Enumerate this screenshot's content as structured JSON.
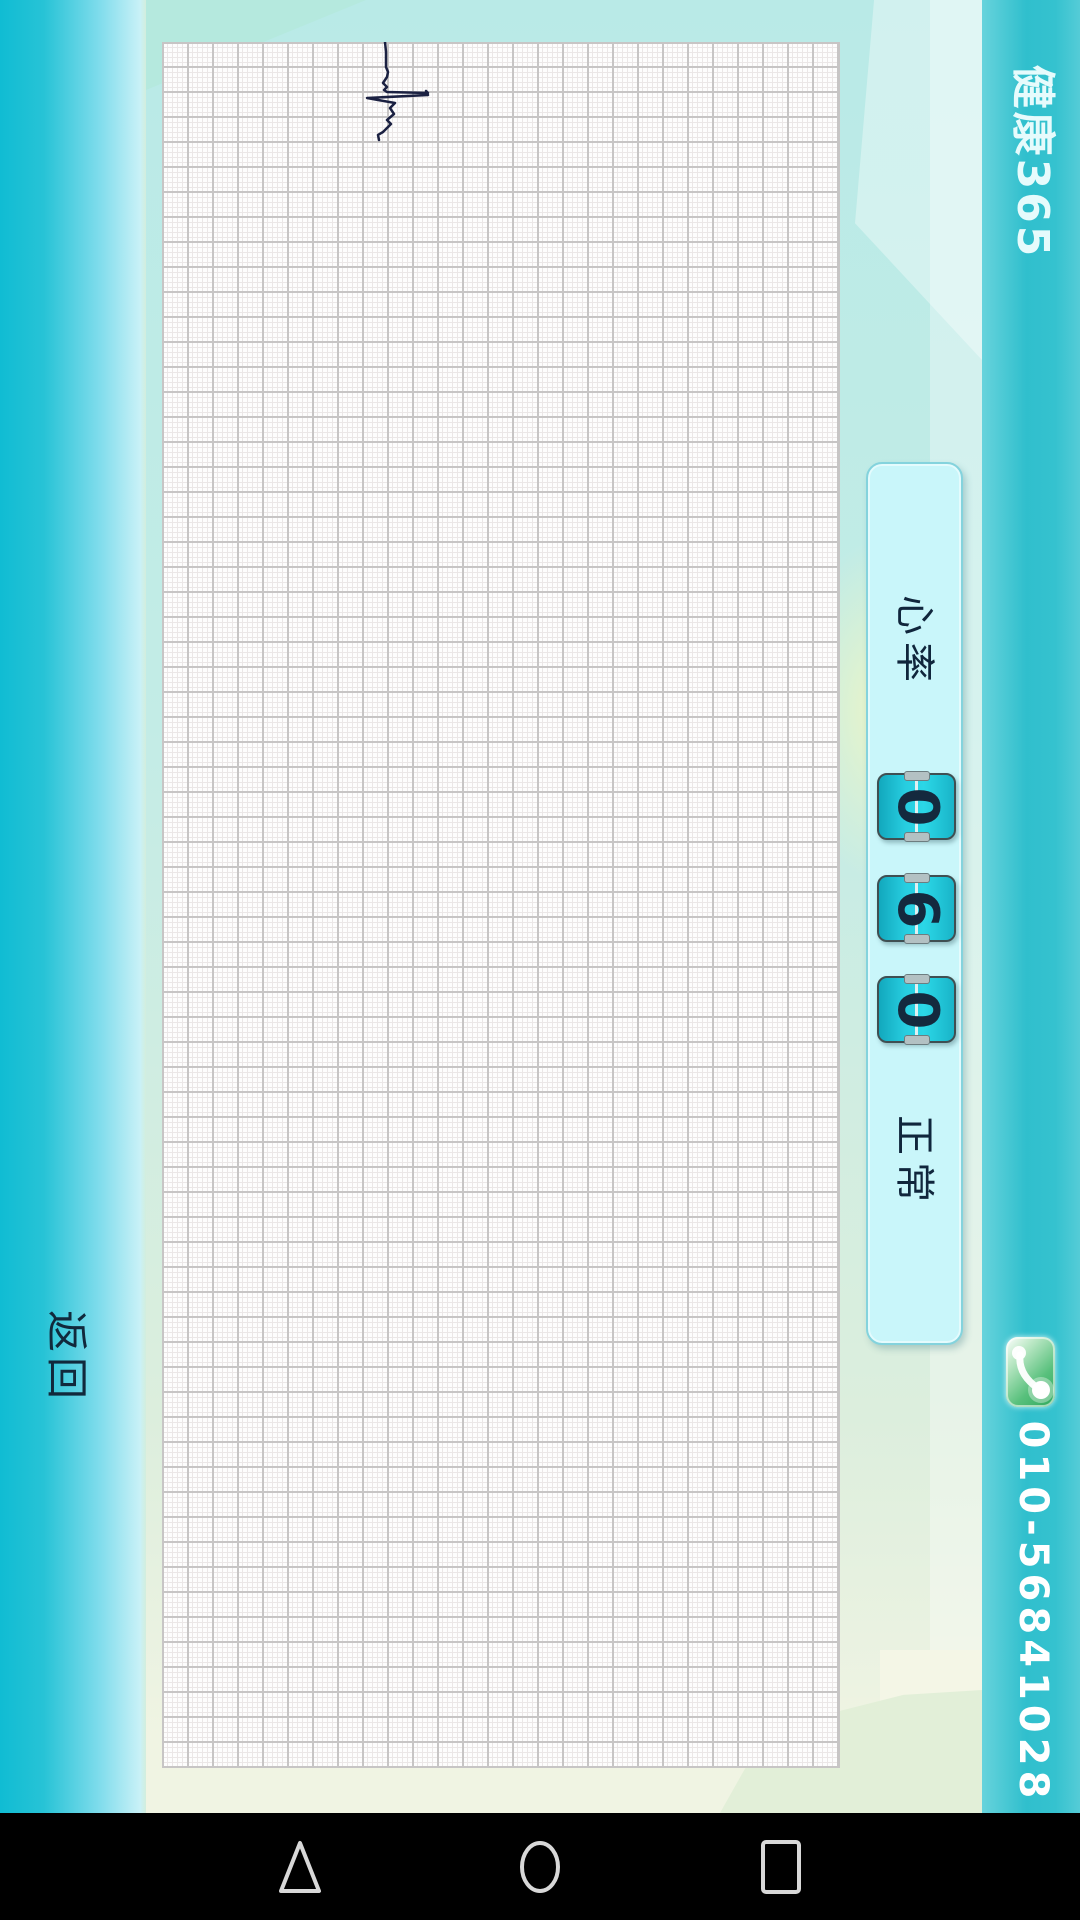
{
  "app": {
    "title": "健康365",
    "back_label": "返回",
    "phone_number": "010-56841028"
  },
  "panel": {
    "label": "心率",
    "digits": [
      "0",
      "6",
      "0"
    ],
    "status": "正常",
    "value": "060"
  },
  "ecg": {
    "description": "single QRS complex trace at top of graph paper, rotated 90deg",
    "points": [
      [
        223,
        0
      ],
      [
        224,
        10
      ],
      [
        224,
        25
      ],
      [
        226,
        30
      ],
      [
        225,
        35
      ],
      [
        221,
        41
      ],
      [
        225,
        45
      ],
      [
        222,
        48
      ],
      [
        225,
        50
      ],
      [
        266,
        51
      ],
      [
        264,
        49
      ],
      [
        266,
        53
      ],
      [
        205,
        56
      ],
      [
        233,
        61
      ],
      [
        228,
        66
      ],
      [
        232,
        72
      ],
      [
        225,
        78
      ],
      [
        229,
        82
      ],
      [
        221,
        90
      ],
      [
        216,
        93
      ],
      [
        217,
        98
      ]
    ]
  },
  "icons": {
    "phone": "phone-handset-icon",
    "nav_back": "triangle-back-icon",
    "nav_home": "circle-home-icon",
    "nav_recents": "square-recents-icon",
    "flip_hinge": "flip-counter-hinge"
  },
  "colors": {
    "strip_cyan": "#10bcd3",
    "strip_teal": "#30bfcd",
    "panel_bg": "#c9f6fa",
    "panel_border": "#84d3dd",
    "tile_teal": "#27cde0",
    "digit_navy": "#14293e",
    "trace_navy": "#1b2142",
    "grid_major": "#c7c5c5",
    "grid_minor": "#ebe7e7",
    "nav_icon_gray": "#d8d8d8",
    "phone_green": "#58c07c",
    "title_white": "#e6fbfc"
  }
}
